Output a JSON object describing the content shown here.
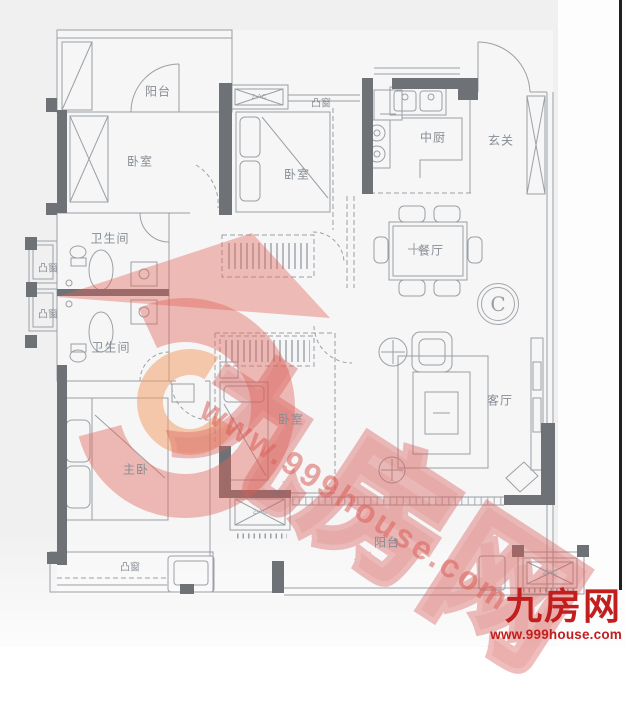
{
  "plan": {
    "rooms": {
      "balcony_top": "阳台",
      "bedroom_top_left": "卧室",
      "bedroom_top_mid": "卧室",
      "bay_top": "凸窗",
      "kitchen": "中厨",
      "foyer": "玄关",
      "bath_upper": "卫生间",
      "bath_lower": "卫生间",
      "bay_left_upper": "凸窗",
      "bay_left_lower": "凸窗",
      "dining": "餐厅",
      "bedroom_mid": "卧室",
      "living": "客厅",
      "master": "主卧",
      "bay_bottom": "凸窗",
      "balcony_bottom": "阳台"
    },
    "unit_label": "C",
    "ac": {
      "top": "2-AC",
      "bottom_left": "2-AC",
      "bottom_right": "2-AC"
    }
  },
  "watermark": {
    "brand": "九房网",
    "url": "www.999house.com"
  },
  "logo": {
    "brand": "九房网",
    "url": "www.999house.com"
  },
  "colors": {
    "wall": "#6e7277",
    "line": "#9ba0a6",
    "label": "#878d94",
    "watermark_red": "#d9605a",
    "logo_red": "#c21e1e"
  }
}
